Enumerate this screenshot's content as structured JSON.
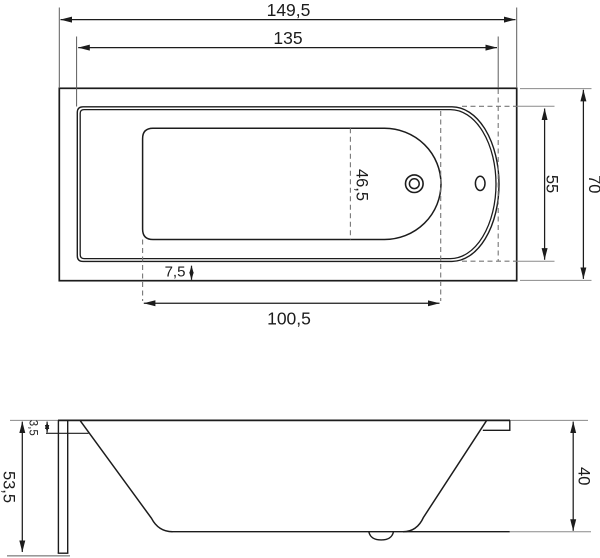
{
  "colors": {
    "ink": "#1c1c1c",
    "dash_lines": "#777777",
    "extension_lines": "#8a8a8a"
  },
  "top_view": {
    "overall_length": "149,5",
    "rim_opening_length": "135",
    "basin_length": "100,5",
    "overall_width": "70",
    "rim_opening_width": "55",
    "basin_width": "46,5",
    "rim_side_offset": "7,5"
  },
  "side_view": {
    "overall_height": "53,5",
    "rim_edge_thickness": "3,5",
    "inner_depth": "40"
  }
}
